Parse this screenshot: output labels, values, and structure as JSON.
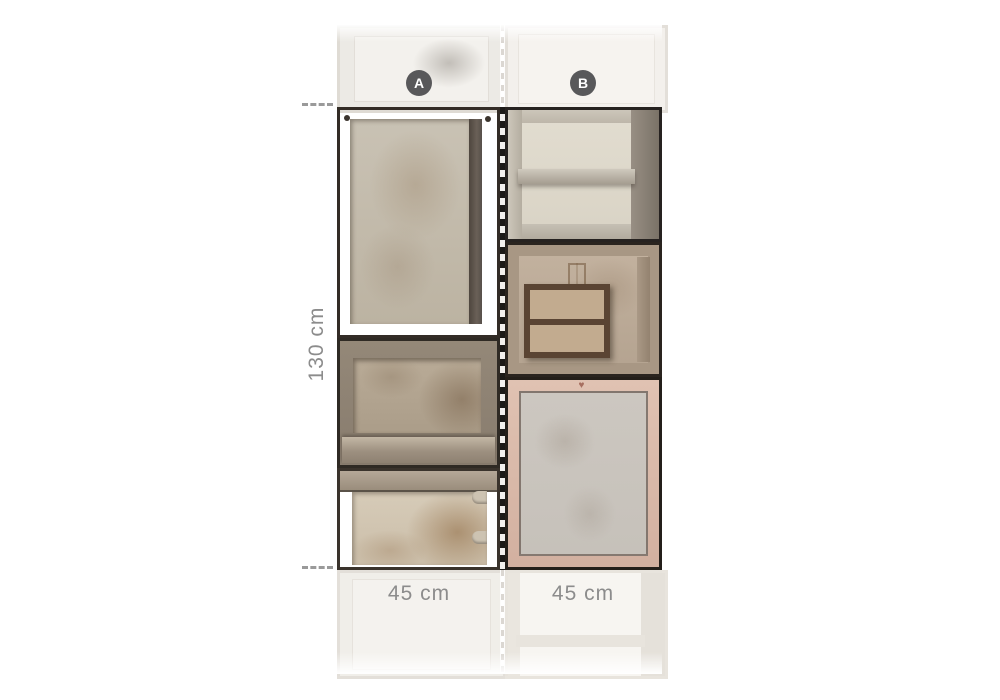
{
  "diagram": {
    "description": "wallpaper pattern repeat diagram with two panel strips",
    "panels": [
      {
        "label": "A",
        "width_label": "45 cm"
      },
      {
        "label": "B",
        "width_label": "45 cm"
      }
    ],
    "height_label": "130 cm"
  },
  "colors": {
    "background": "#ffffff",
    "badge_bg": "#58585a",
    "badge_text": "#ffffff",
    "dimension_text": "#8c8c8c",
    "tick_dash": "#9a9a9a",
    "divider_dark": "#1c1a18",
    "divider_light": "#f2f0ee"
  }
}
